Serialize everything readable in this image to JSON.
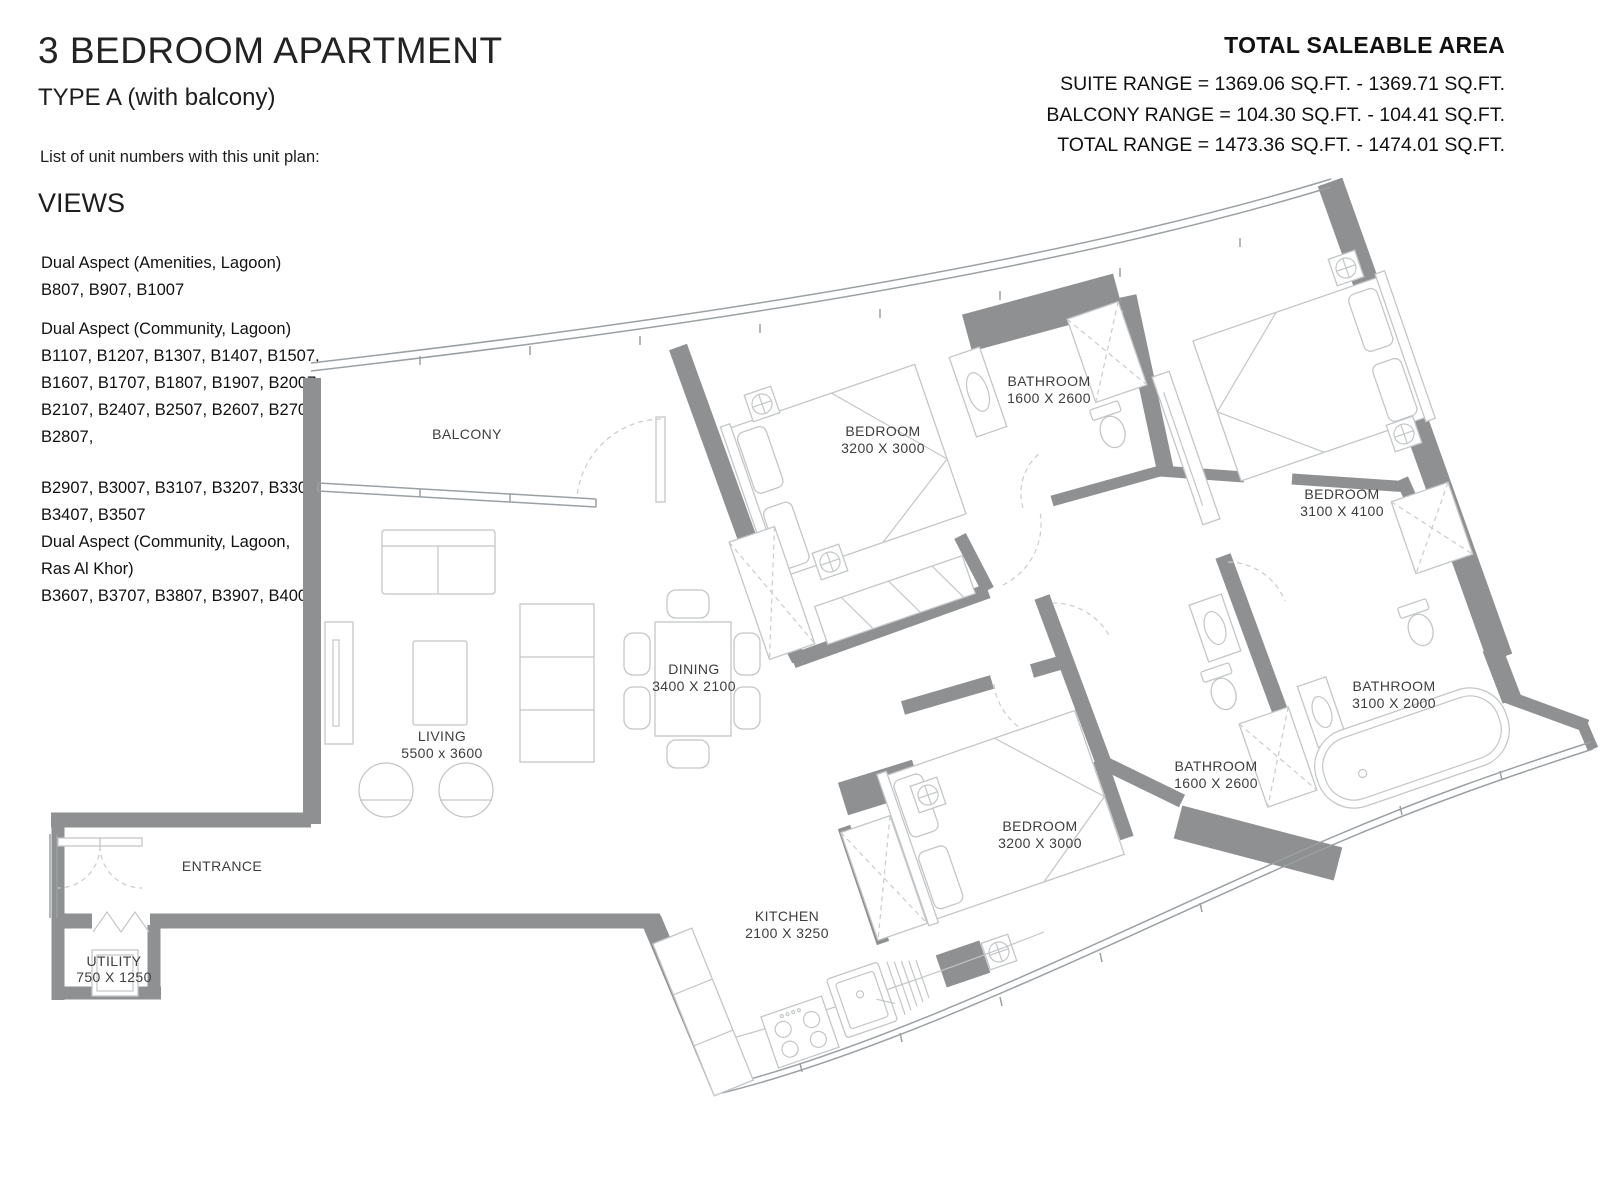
{
  "header": {
    "title": "3 BEDROOM APARTMENT",
    "subtitle": "TYPE A (with balcony)",
    "intro": "List of unit numbers with this unit plan:",
    "views_heading": "VIEWS"
  },
  "unit_list": {
    "lines": [
      "Dual Aspect (Amenities, Lagoon)",
      "B807, B907, B1007",
      "Dual Aspect (Community, Lagoon)",
      "B1107, B1207, B1307, B1407, B1507,",
      "B1607, B1707, B1807, B1907, B2007,",
      "B2107, B2407, B2507, B2607, B2707,",
      "B2807,",
      "B2907, B3007, B3107, B3207, B3307,",
      "B3407, B3507",
      "Dual Aspect (Community, Lagoon,",
      "Ras Al Khor)",
      "B3607, B3707, B3807, B3907, B4007"
    ]
  },
  "area_summary": {
    "title": "TOTAL SALEABLE AREA",
    "lines": [
      "SUITE RANGE = 1369.06 SQ.FT. - 1369.71 SQ.FT.",
      "BALCONY RANGE = 104.30 SQ.FT. - 104.41 SQ.FT.",
      "TOTAL RANGE = 1473.36 SQ.FT. - 1474.01 SQ.FT."
    ]
  },
  "rooms": {
    "balcony": {
      "name": "BALCONY"
    },
    "living": {
      "name": "LIVING",
      "dims": "5500 x 3600"
    },
    "dining": {
      "name": "DINING",
      "dims": "3400 X 2100"
    },
    "bedroom1": {
      "name": "BEDROOM",
      "dims": "3200 X 3000"
    },
    "bathroom1": {
      "name": "BATHROOM",
      "dims": "1600 X 2600"
    },
    "bedroom2": {
      "name": "BEDROOM",
      "dims": "3100 X 4100"
    },
    "bathroom2": {
      "name": "BATHROOM",
      "dims": "1600 X 2600"
    },
    "bathroom3": {
      "name": "BATHROOM",
      "dims": "3100 X 2000"
    },
    "bedroom3": {
      "name": "BEDROOM",
      "dims": "3200 X 3000"
    },
    "kitchen": {
      "name": "KITCHEN",
      "dims": "2100 X 3250"
    },
    "entrance": {
      "name": "ENTRANCE"
    },
    "utility": {
      "name": "UTILITY",
      "dims": "750 X 1250"
    }
  },
  "colors": {
    "wall": "#8e9092",
    "window_line": "#9aa0a3",
    "furniture_line": "#c3c6c8",
    "door_dash": "#c9cbcd",
    "text": "#1d1d1d",
    "label": "#3e3e3e"
  }
}
